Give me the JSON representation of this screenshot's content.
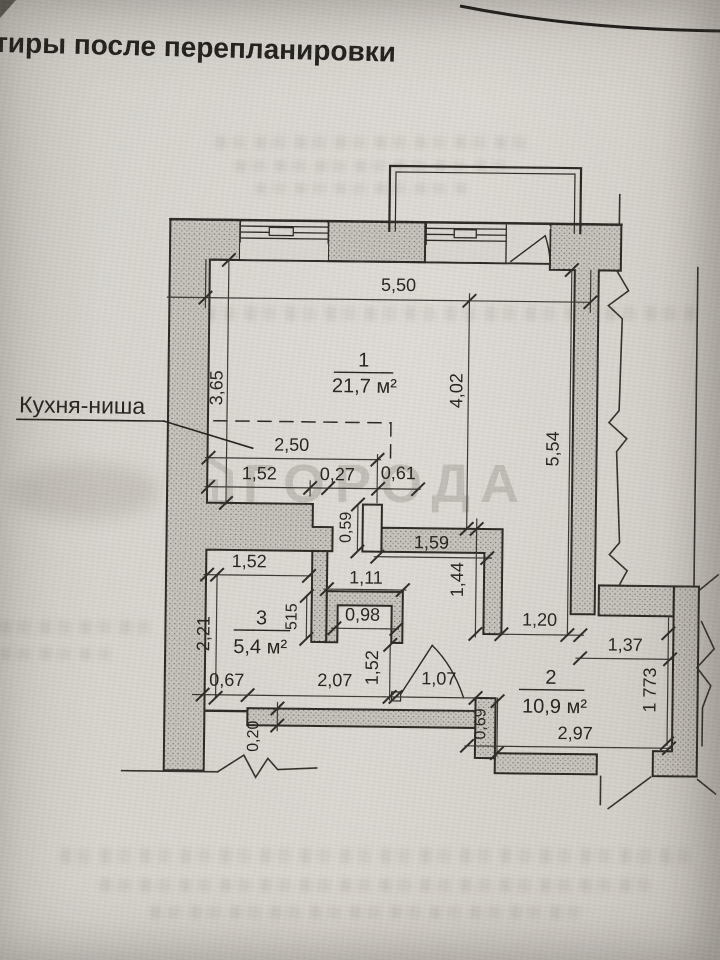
{
  "page": {
    "title_fragment": "тиры после перепланировки",
    "watermark": "ГОРОДА"
  },
  "colors": {
    "paper": "#d6d2cc",
    "ink": "#2b2824",
    "wall_fill": "#c7c3bd",
    "watermark": "#a5a09a"
  },
  "plan": {
    "kitchen_label": "Кухня-ниша",
    "room1_number": "1",
    "room1_area": "21,7 м²",
    "room2_number": "2",
    "room2_area": "10,9 м²",
    "room3_number": "3",
    "room3_area": "5,4 м²",
    "dims": {
      "top_width": "5,50",
      "room1_left": "3,65",
      "room1_mid": "4,02",
      "right_wall": "5,54",
      "niche_total": "2,50",
      "niche_a": "1,52",
      "niche_b": "0,27",
      "niche_c": "0,61",
      "stub": "0,59",
      "partition": "1,59",
      "inner_wall": "1,44",
      "duct_outer": "1,11",
      "duct_inner": "0,98",
      "shaft": "515",
      "room3_top": "1,52",
      "room3_left": "2,21",
      "door_vert": "1,52",
      "corridor_opening": "1,20",
      "room2_top": "1,37",
      "room2_right": "1 773",
      "room2_stub": "0,69",
      "room2_bottom": "2,97",
      "bottom_a": "0,67",
      "bottom_b": "2,07",
      "bottom_c": "1,07",
      "wall_t": "0,20"
    }
  }
}
